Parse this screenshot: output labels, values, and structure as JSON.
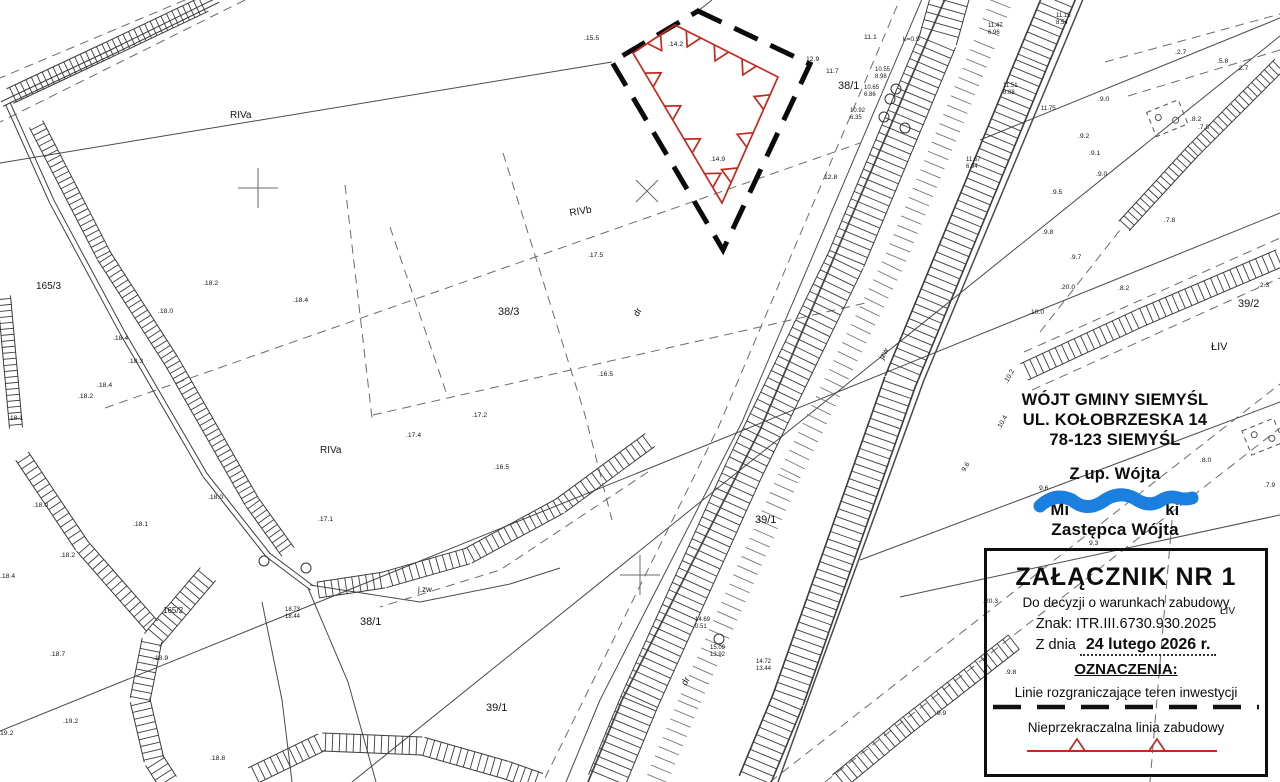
{
  "colors": {
    "red": "#c5281f",
    "blue": "#1b7fe0",
    "ink": "#3f3f3f"
  },
  "stamp": {
    "line1": "WÓJT GMINY SIEMYŚL",
    "line2": "UL. KOŁOBRZESKA 14",
    "line3": "78-123 SIEMYŚL",
    "authorization": "Z up. Wójta",
    "sig_left": "Mi",
    "sig_right": "ki",
    "deputy_title": "Zastępca Wójta"
  },
  "legend": {
    "title": "ZAŁĄCZNIK  NR  1",
    "subtitle": "Do decyzji o warunkach zabudowy",
    "ref": "Znak: ITR.III.6730.930.2025",
    "date_prefix": "Z dnia",
    "date_value": "24 lutego 2026 r.",
    "symbols_heading": "OZNACZENIA:",
    "symbol1_label": "Linie rozgraniczające teren inwestycji",
    "symbol2_label": "Nieprzekraczalna linia zabudowy"
  },
  "map_labels": [
    {
      "t": ".15.5",
      "x": 584,
      "y": 40
    },
    {
      "t": ".14.2",
      "x": 668,
      "y": 46
    },
    {
      "t": ".14.9",
      "x": 710,
      "y": 161
    },
    {
      "t": ".17.5",
      "x": 588,
      "y": 257
    },
    {
      "t": ".16.5",
      "x": 598,
      "y": 376
    },
    {
      "t": ".17.2",
      "x": 472,
      "y": 417
    },
    {
      "t": ".17.4",
      "x": 406,
      "y": 437
    },
    {
      "t": ".16.5",
      "x": 494,
      "y": 469
    },
    {
      "t": ".17.1",
      "x": 318,
      "y": 521
    },
    {
      "t": ".18.2",
      "x": 203,
      "y": 285
    },
    {
      "t": ".18.0",
      "x": 158,
      "y": 313
    },
    {
      "t": ".18.4",
      "x": 293,
      "y": 302
    },
    {
      "t": ".18.4",
      "x": 113,
      "y": 340
    },
    {
      "t": ".18.3",
      "x": 128,
      "y": 363
    },
    {
      "t": ".18.4",
      "x": 97,
      "y": 387
    },
    {
      "t": ".18.2",
      "x": 78,
      "y": 398
    },
    {
      "t": ".18.1",
      "x": 8,
      "y": 420
    },
    {
      "t": ".18.0",
      "x": 33,
      "y": 507
    },
    {
      "t": ".18.1",
      "x": 133,
      "y": 526
    },
    {
      "t": ".18.0",
      "x": 208,
      "y": 499
    },
    {
      "t": ".18.4",
      "x": 0,
      "y": 578
    },
    {
      "t": ".18.2",
      "x": 60,
      "y": 557
    },
    {
      "t": ".18.7",
      "x": 50,
      "y": 656
    },
    {
      "t": ".18.9",
      "x": 153,
      "y": 660
    },
    {
      "t": ".19.2",
      "x": 63,
      "y": 723
    },
    {
      "t": "19.2",
      "x": 0,
      "y": 735
    },
    {
      "t": ".18.8",
      "x": 210,
      "y": 760
    },
    {
      "t": ".9.0",
      "x": 1098,
      "y": 101
    },
    {
      "t": ".9.2",
      "x": 1078,
      "y": 138
    },
    {
      "t": ".9.1",
      "x": 1089,
      "y": 155
    },
    {
      "t": ".9.0",
      "x": 1096,
      "y": 176
    },
    {
      "t": ".9.5",
      "x": 1051,
      "y": 194
    },
    {
      "t": ".9.8",
      "x": 1042,
      "y": 234
    },
    {
      "t": ".9.7",
      "x": 1070,
      "y": 259
    },
    {
      "t": ".20.0",
      "x": 1060,
      "y": 289
    },
    {
      "t": ".8.2",
      "x": 1118,
      "y": 290
    },
    {
      "t": ".2.3",
      "x": 1258,
      "y": 287
    },
    {
      "t": ".7.8",
      "x": 1164,
      "y": 222
    },
    {
      "t": ".8.2",
      "x": 1190,
      "y": 121
    },
    {
      "t": ".7.8",
      "x": 1198,
      "y": 129
    },
    {
      "t": ".2.7",
      "x": 1175,
      "y": 54
    },
    {
      "t": ".5.8",
      "x": 1217,
      "y": 63
    },
    {
      "t": ".2.7",
      "x": 1237,
      "y": 70
    },
    {
      "t": ".8.0",
      "x": 1200,
      "y": 462
    },
    {
      "t": ".7.9",
      "x": 1264,
      "y": 487
    },
    {
      "t": "9.6",
      "x": 1039,
      "y": 490
    },
    {
      "t": "9.3",
      "x": 1089,
      "y": 545
    },
    {
      "t": ".10.0",
      "x": 1029,
      "y": 314
    },
    {
      "t": ".10.2",
      "x": 1007,
      "y": 384,
      "r": -60
    },
    {
      "t": ".10.4",
      "x": 1000,
      "y": 430,
      "r": -60
    },
    {
      "t": "9.6",
      "x": 965,
      "y": 472,
      "r": -60
    },
    {
      "t": ".20.3",
      "x": 983,
      "y": 603
    },
    {
      "t": ".9.8",
      "x": 1005,
      "y": 674
    },
    {
      "t": ".9.9",
      "x": 935,
      "y": 715
    },
    {
      "t": "11.1",
      "x": 864,
      "y": 39
    },
    {
      "t": "k=0.9",
      "x": 903,
      "y": 41
    },
    {
      "t": "12.9",
      "x": 806,
      "y": 61
    },
    {
      "t": "11.7",
      "x": 826,
      "y": 73
    },
    {
      "t": "10.55",
      "x": 875,
      "y": 71,
      "s": 6
    },
    {
      "t": "8.98",
      "x": 875,
      "y": 78,
      "s": 6
    },
    {
      "t": "10.65",
      "x": 864,
      "y": 89,
      "s": 6
    },
    {
      "t": "6.86",
      "x": 864,
      "y": 96,
      "s": 6
    },
    {
      "t": "10.92",
      "x": 850,
      "y": 112,
      "s": 6
    },
    {
      "t": "6.35",
      "x": 850,
      "y": 119,
      "s": 6
    },
    {
      "t": "11.47",
      "x": 988,
      "y": 27,
      "s": 6
    },
    {
      "t": "6.96",
      "x": 988,
      "y": 34,
      "s": 6
    },
    {
      "t": "11.15",
      "x": 1056,
      "y": 17,
      "s": 6
    },
    {
      "t": "8.54",
      "x": 1056,
      "y": 24,
      "s": 6
    },
    {
      "t": "11.51",
      "x": 1003,
      "y": 87,
      "s": 6
    },
    {
      "t": "8.88",
      "x": 1003,
      "y": 94,
      "s": 6
    },
    {
      "t": "11.75",
      "x": 1041,
      "y": 110,
      "s": 6
    },
    {
      "t": "11.67",
      "x": 966,
      "y": 161,
      "s": 6
    },
    {
      "t": "6.94",
      "x": 966,
      "y": 168,
      "s": 6
    },
    {
      "t": "12.8",
      "x": 824,
      "y": 179
    },
    {
      "t": "14.69",
      "x": 695,
      "y": 621,
      "s": 6
    },
    {
      "t": "0.51",
      "x": 695,
      "y": 628,
      "s": 6
    },
    {
      "t": "15.09",
      "x": 710,
      "y": 649,
      "s": 6
    },
    {
      "t": "13.92",
      "x": 710,
      "y": 656,
      "s": 6
    },
    {
      "t": "14.72",
      "x": 756,
      "y": 663,
      "s": 6
    },
    {
      "t": "13.44",
      "x": 756,
      "y": 670,
      "s": 6
    },
    {
      "t": "18.73",
      "x": 285,
      "y": 611,
      "s": 6
    },
    {
      "t": "18.44",
      "x": 285,
      "y": 618,
      "s": 6
    },
    {
      "t": "RIVa",
      "x": 230,
      "y": 118,
      "s": 10
    },
    {
      "t": "RIVa",
      "x": 320,
      "y": 453,
      "s": 10
    },
    {
      "t": "RIVb",
      "x": 570,
      "y": 216,
      "s": 10,
      "r": -9
    },
    {
      "t": "38/3",
      "x": 498,
      "y": 315,
      "s": 11
    },
    {
      "t": "38/1",
      "x": 838,
      "y": 89,
      "s": 11
    },
    {
      "t": "38/1",
      "x": 360,
      "y": 625,
      "s": 11
    },
    {
      "t": "39/1",
      "x": 755,
      "y": 523,
      "s": 11
    },
    {
      "t": "39/1",
      "x": 486,
      "y": 711,
      "s": 11
    },
    {
      "t": "39/2",
      "x": 1238,
      "y": 307,
      "s": 11
    },
    {
      "t": "ŁIV",
      "x": 1211,
      "y": 350,
      "s": 11
    },
    {
      "t": "ŁIV",
      "x": 1220,
      "y": 614,
      "s": 10
    },
    {
      "t": "165/3",
      "x": 36,
      "y": 289,
      "s": 10
    },
    {
      "t": "165/2",
      "x": 163,
      "y": 613,
      "s": 8
    },
    {
      "t": "j.zw",
      "x": 418,
      "y": 592,
      "s": 8
    },
    {
      "t": "jzw",
      "x": 883,
      "y": 360,
      "s": 8,
      "r": -60
    },
    {
      "t": "dr",
      "x": 686,
      "y": 686,
      "s": 9,
      "r": -60
    },
    {
      "t": "dr",
      "x": 638,
      "y": 317,
      "s": 9,
      "r": -60
    }
  ]
}
